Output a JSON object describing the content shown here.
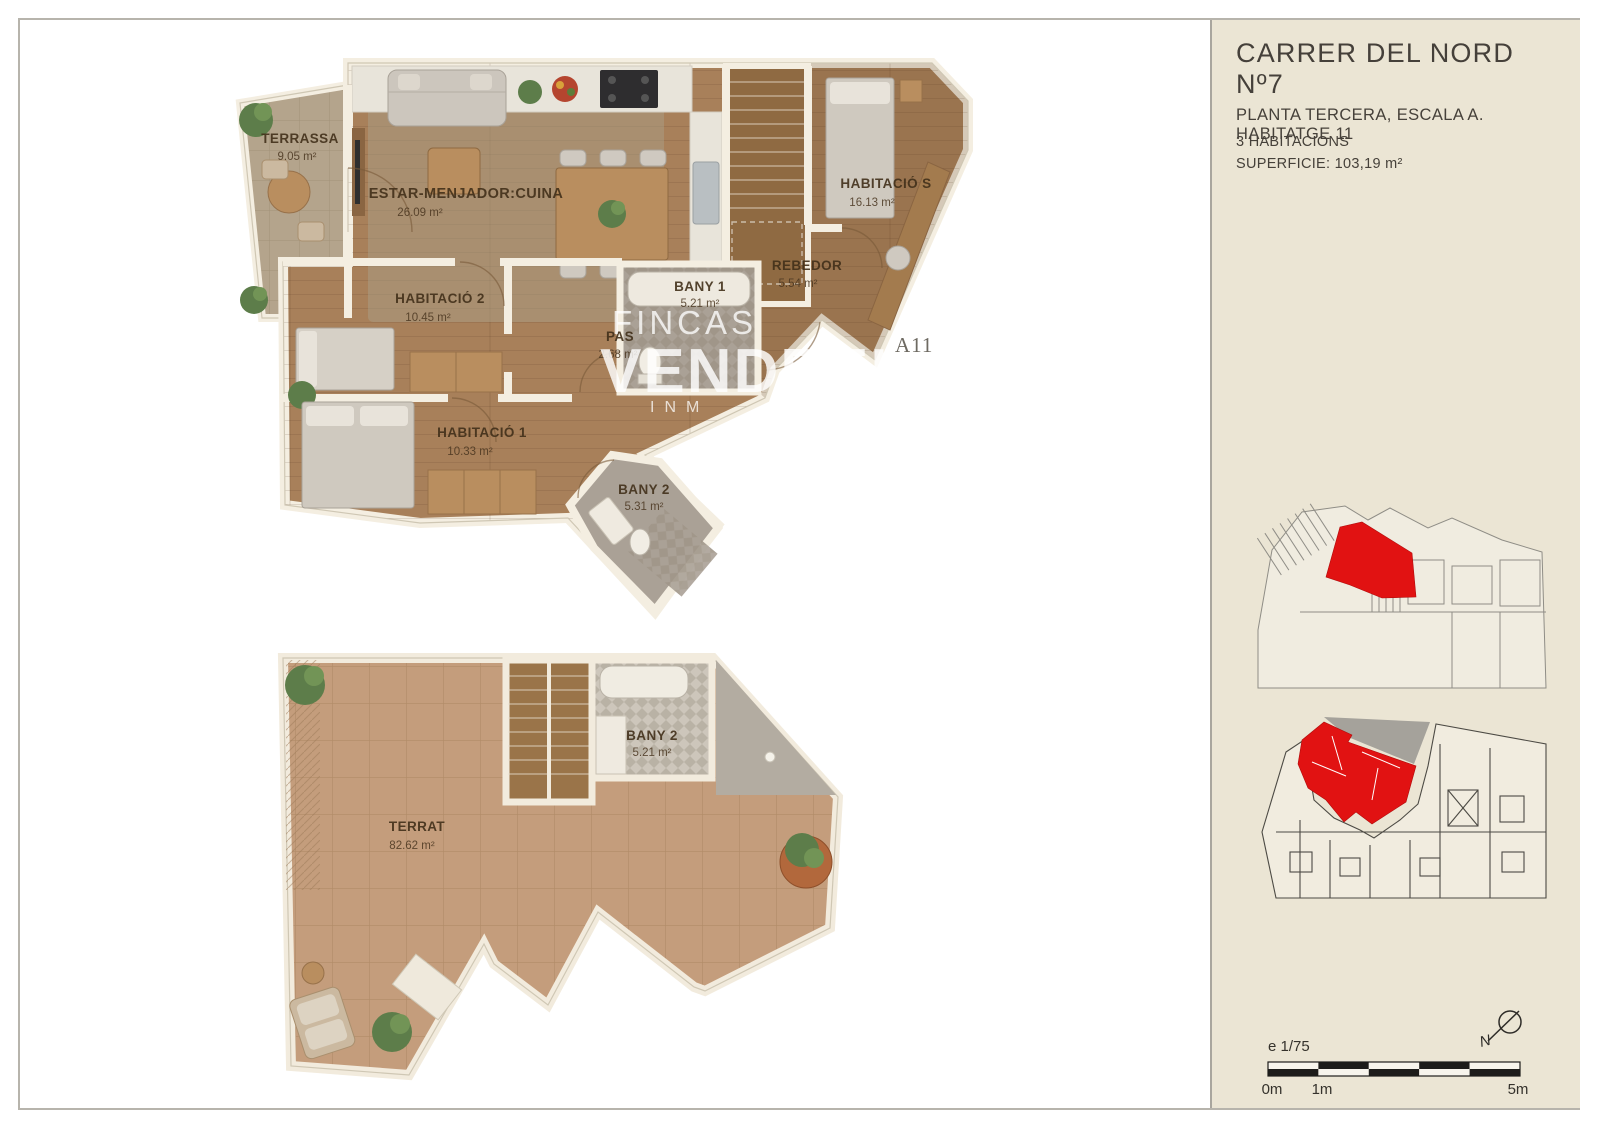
{
  "colors": {
    "sidebar_bg": "#ebe5d4",
    "accent_red": "#e11212",
    "wood": "#a8805a",
    "terrace_stone": "#b4a48c",
    "terrat_tile": "#c49d7c",
    "wall": "#f4eee1"
  },
  "sidebar": {
    "title": "CARRER DEL NORD Nº7",
    "subtitle": "PLANTA TERCERA, ESCALA A. HABITATGE 11",
    "detail_rooms": "3 HABITACIONS",
    "detail_surface": "SUPERFICIE: 103,19 m²",
    "scale_label": "e 1/75",
    "ticks": [
      "0m",
      "1m",
      "5m"
    ],
    "north_label": "N"
  },
  "watermark": {
    "line1": "FINCAS",
    "line2": "VENDRELL M",
    "line3": "INM",
    "unit": "A11"
  },
  "plan_upper": {
    "rooms": [
      {
        "name": "TERRASSA",
        "area": "9.05 m²"
      },
      {
        "name": "ESTAR-MENJADOR:CUINA",
        "area": "26.09 m²"
      },
      {
        "name": "HABITACIÓ S",
        "area": "16.13 m²"
      },
      {
        "name": "REBEDOR",
        "area": "5.54 m²"
      },
      {
        "name": "HABITACIÓ 2",
        "area": "10.45 m²"
      },
      {
        "name": "PAS",
        "area": "2.68 m²"
      },
      {
        "name": "BANY 1",
        "area": "5.21 m²"
      },
      {
        "name": "HABITACIÓ 1",
        "area": "10.33 m²"
      },
      {
        "name": "BANY 2",
        "area": "5.31 m²"
      }
    ]
  },
  "plan_lower": {
    "rooms": [
      {
        "name": "TERRAT",
        "area": "82.62 m²"
      },
      {
        "name": "BANY 2",
        "area": "5.21 m²"
      }
    ]
  }
}
